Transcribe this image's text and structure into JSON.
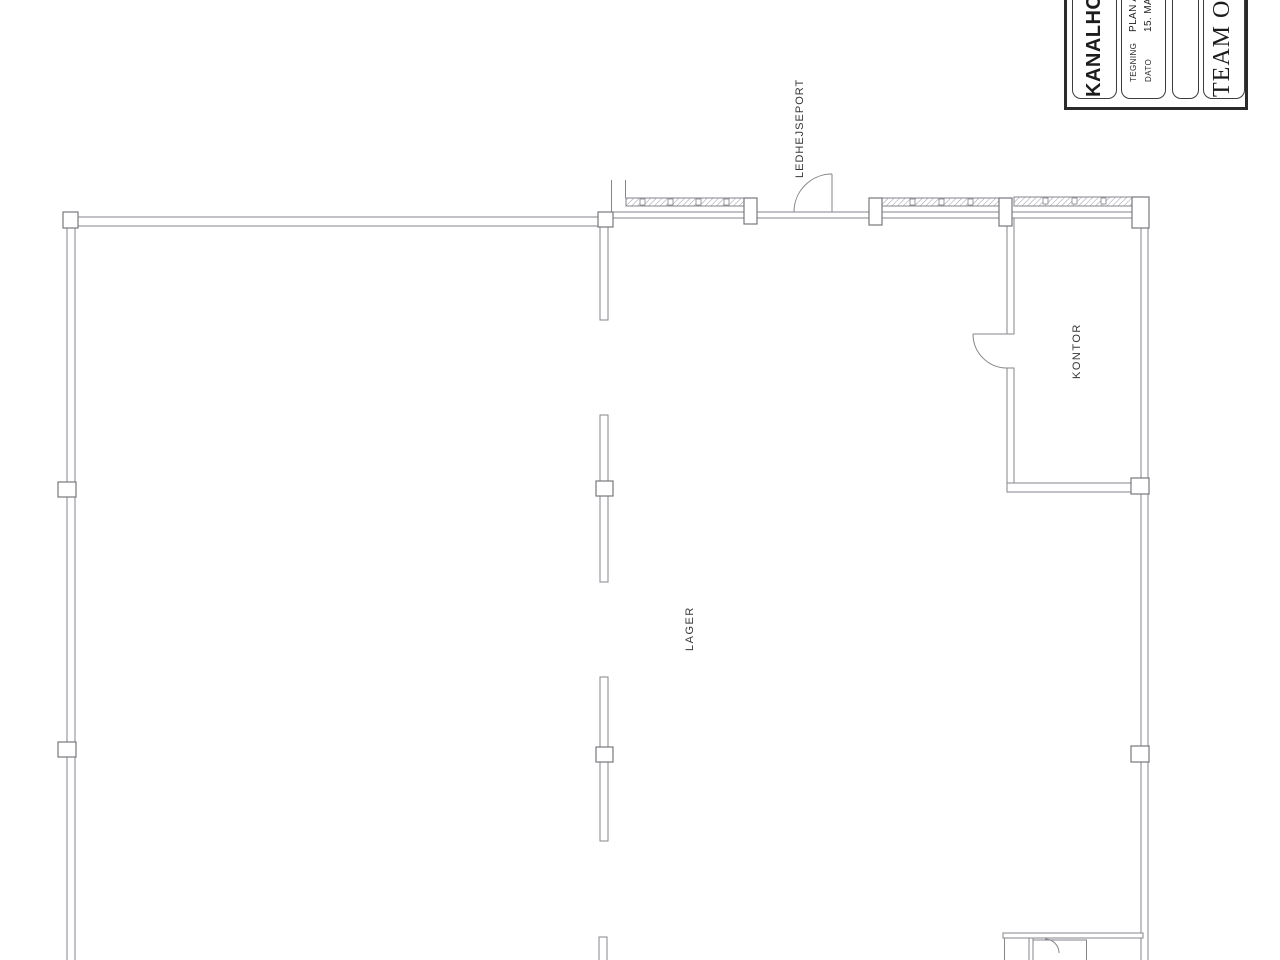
{
  "document": {
    "kind": "scanned architectural floor plan"
  },
  "plan": {
    "rooms": [
      {
        "id": "lager",
        "label": "LAGER"
      },
      {
        "id": "kontor",
        "label": "KONTOR"
      }
    ],
    "annotations": [
      {
        "id": "ledhejseport",
        "label": "LEDHEJSEPORT"
      }
    ]
  },
  "title_block": {
    "project_title": "KANALHOLM",
    "fields": [
      {
        "label": "TEGNING",
        "value": "PLAN A"
      },
      {
        "label": "DATO",
        "value": "15. MAJ"
      }
    ],
    "company": "TEAM OPT"
  },
  "theme": {
    "background": "#ffffff",
    "line_color": "#85858d",
    "col_color": "#77777f",
    "label_color": "#35353b",
    "title_text_color": "#1c1c1f",
    "border_color": "#2b2b2e"
  }
}
